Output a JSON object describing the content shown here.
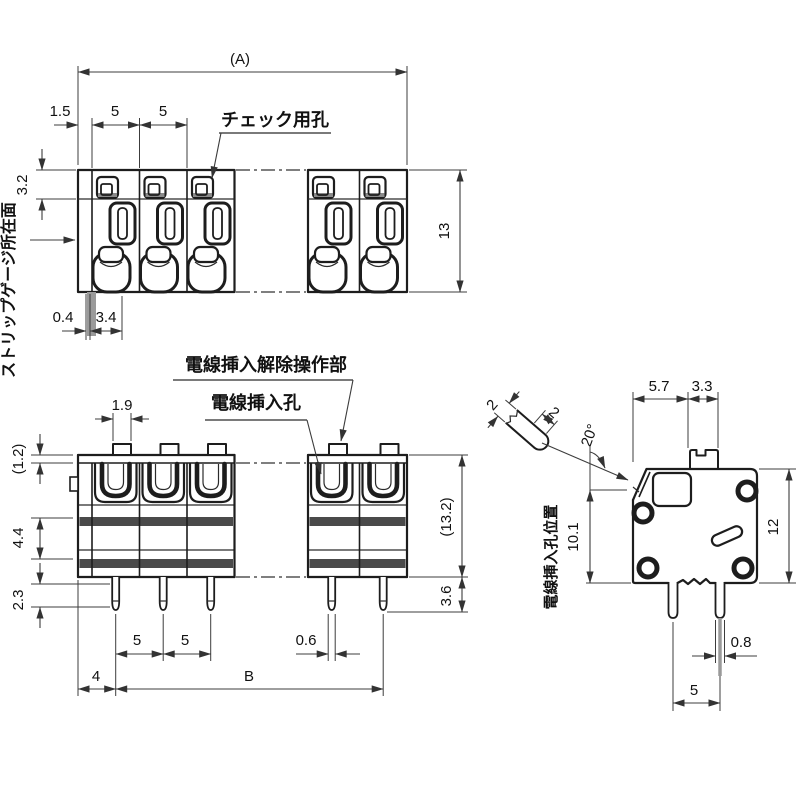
{
  "drawing": {
    "background": "#ffffff",
    "line_color": "#1d1d1d",
    "labels": {
      "check_hole": "チェック用孔",
      "strip_gauge_face": "ストリップゲージ所在面",
      "wire_release": "電線挿入解除操作部",
      "wire_hole": "電線挿入孔",
      "wire_hole_pos": "電線挿入孔位置"
    },
    "top_view": {
      "dims": {
        "overall_width": "(A)",
        "edge_offset": "1.5",
        "pitch_1": "5",
        "pitch_2": "5",
        "check_hole_depth": "3.2",
        "depth": "13",
        "gauge_offset": "0.4",
        "gauge_width": "3.4"
      }
    },
    "front_view": {
      "dims": {
        "tab_width": "1.9",
        "plate_height": "(1.2)",
        "band_gap": "4.4",
        "pin_upper": "2.3",
        "pitch_1": "5",
        "pitch_2": "5",
        "pin_width": "0.6",
        "end_offset": "4",
        "span": "B",
        "height": "(13.2)",
        "pin_length": "3.6"
      }
    },
    "side_view": {
      "dims": {
        "wire_dia_1": "2",
        "wire_dia_2": "2",
        "entry_angle": "20°",
        "front_depth": "5.7",
        "lever_depth": "3.3",
        "hole_height": "10.1",
        "height": "12",
        "pin_width": "0.8",
        "pin_pitch": "5"
      }
    }
  }
}
